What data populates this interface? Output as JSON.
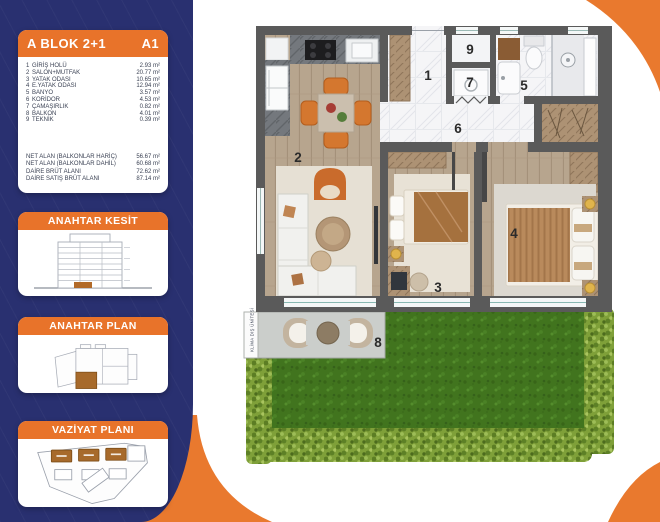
{
  "colors": {
    "navy": "#293070",
    "orange": "#e8732a",
    "wall": "#5a5a5a",
    "grass": "#41741e",
    "hedge": "#7fa039"
  },
  "sidebar": {
    "unit_card": {
      "title": "A BLOK 2+1",
      "unit_code": "A1",
      "rooms": [
        {
          "no": "1",
          "name": "GİRİŞ HOLÜ",
          "area": "2.93 m²"
        },
        {
          "no": "2",
          "name": "SALON+MUTFAK",
          "area": "20.77 m²"
        },
        {
          "no": "3",
          "name": "YATAK ODASI",
          "area": "10.65 m²"
        },
        {
          "no": "4",
          "name": "E.YATAK ODASI",
          "area": "12.94 m²"
        },
        {
          "no": "5",
          "name": "BANYO",
          "area": "3.57 m²"
        },
        {
          "no": "6",
          "name": "KORİDOR",
          "area": "4.53 m²"
        },
        {
          "no": "7",
          "name": "ÇAMAŞIRLIK",
          "area": "0.82 m²"
        },
        {
          "no": "8",
          "name": "BALKON",
          "area": "4.01 m²"
        },
        {
          "no": "9",
          "name": "TEKNİK",
          "area": "0.39 m²"
        }
      ],
      "totals": [
        {
          "label": "NET ALAN (BALKONLAR HARİÇ)",
          "value": "56.67 m²"
        },
        {
          "label": "NET ALAN (BALKONLAR DAHİL)",
          "value": "60.68 m²"
        },
        {
          "label": "DAİRE BRÜT ALANI",
          "value": "72.62 m²"
        },
        {
          "label": "DAİRE SATIŞ BRÜT ALANI",
          "value": "87.14 m²"
        }
      ]
    },
    "section_cards": [
      {
        "title": "ANAHTAR KESİT"
      },
      {
        "title": "ANAHTAR PLAN"
      },
      {
        "title": "VAZİYAT PLANI"
      }
    ]
  },
  "floorplan": {
    "room_numbers": {
      "n1": "1",
      "n2": "2",
      "n3": "3",
      "n4": "4",
      "n5": "5",
      "n6": "6",
      "n7": "7",
      "n8": "8",
      "n9": "9"
    },
    "balcony_unit_label": "KLİMA DIŞ ÜNİTESİ"
  }
}
